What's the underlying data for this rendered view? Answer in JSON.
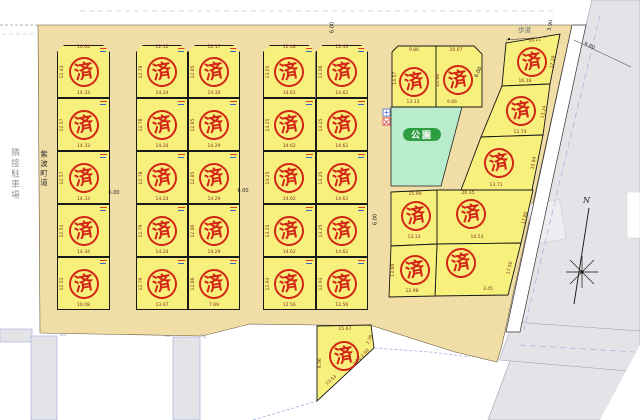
{
  "labels": {
    "adjacent_parking": "隣接駐車場",
    "road_name": "紫波町道",
    "park": "公園",
    "sidewalk": "歩道",
    "north": "N",
    "stamp": "済"
  },
  "colors": {
    "lot_yellow": "#f7f07c",
    "road_tan": "#f1dda6",
    "stamp_red": "#d22616",
    "park_green": "#b9eccd",
    "park_badge_green": "#2f9e43",
    "highway_gray": "#e4e4e8"
  },
  "road_dims": [
    "6.00",
    "6.00",
    "6.00",
    "6.00",
    "6.00",
    "9.00",
    "3.90"
  ],
  "blocks": {
    "A": {
      "top_dims": [
        "10.04"
      ],
      "lots": [
        {
          "w": "14.33",
          "h": "12.43"
        },
        {
          "w": "14.33",
          "h": "12.57"
        },
        {
          "w": "14.33",
          "h": "12.57"
        },
        {
          "w": "14.34",
          "h": "12.51"
        },
        {
          "w": "10.08",
          "h": "12.51"
        }
      ]
    },
    "B": {
      "top_dims": [
        "12.12",
        "12.17"
      ],
      "lots": [
        {
          "w": "14.24",
          "h": "12.78"
        },
        {
          "w": "14.30",
          "h": "12.85"
        },
        {
          "w": "14.24",
          "h": "12.78"
        },
        {
          "w": "14.29",
          "h": "12.85"
        },
        {
          "w": "14.24",
          "h": "12.78"
        },
        {
          "w": "14.29",
          "h": "12.85"
        },
        {
          "w": "14.24",
          "h": "12.79"
        },
        {
          "w": "14.29",
          "h": "12.86"
        },
        {
          "w": "13.07",
          "h": "12.79"
        },
        {
          "w": "7.69",
          "h": "12.86"
        }
      ]
    },
    "C": {
      "top_dims": [
        "12.48",
        "12.49"
      ],
      "lots": [
        {
          "w": "14.61",
          "h": "13.05"
        },
        {
          "w": "14.62",
          "h": "13.06"
        },
        {
          "w": "14.62",
          "h": "13.25"
        },
        {
          "w": "14.62",
          "h": "13.25"
        },
        {
          "w": "14.62",
          "h": "13.25"
        },
        {
          "w": "14.62",
          "h": "13.25"
        },
        {
          "w": "14.62",
          "h": "13.25"
        },
        {
          "w": "14.62",
          "h": "13.25"
        },
        {
          "w": "12.56",
          "h": "12.93"
        },
        {
          "w": "12.56",
          "h": "12.93"
        }
      ]
    }
  },
  "irregular_lots": [
    {
      "id": "D1",
      "top": "9.86",
      "bottom": "13.13",
      "side": "14.57"
    },
    {
      "id": "D2",
      "top": "10.07",
      "bottom": "9.66",
      "side": "14.66"
    },
    {
      "id": "E1",
      "top": "18.21",
      "bottom": "16.16",
      "side": "17.28"
    },
    {
      "id": "E2",
      "bottom": "12.74",
      "side": "13.24"
    },
    {
      "id": "E3",
      "bottom": "13.71",
      "side": "15.84"
    },
    {
      "id": "F1",
      "top": "15.99",
      "bottom": "13.13"
    },
    {
      "id": "F2",
      "top": "20.35",
      "bottom": "10.53",
      "side": "17.80"
    },
    {
      "id": "F3",
      "bottom": "12.98",
      "side": "13.68"
    },
    {
      "id": "F4",
      "bottom": "3.45",
      "side": "17.50"
    },
    {
      "id": "G",
      "top": "15.67",
      "bottom": "13.53",
      "side": "7.76",
      "side2": "9.36",
      "extra": "2.00 2.50"
    }
  ]
}
